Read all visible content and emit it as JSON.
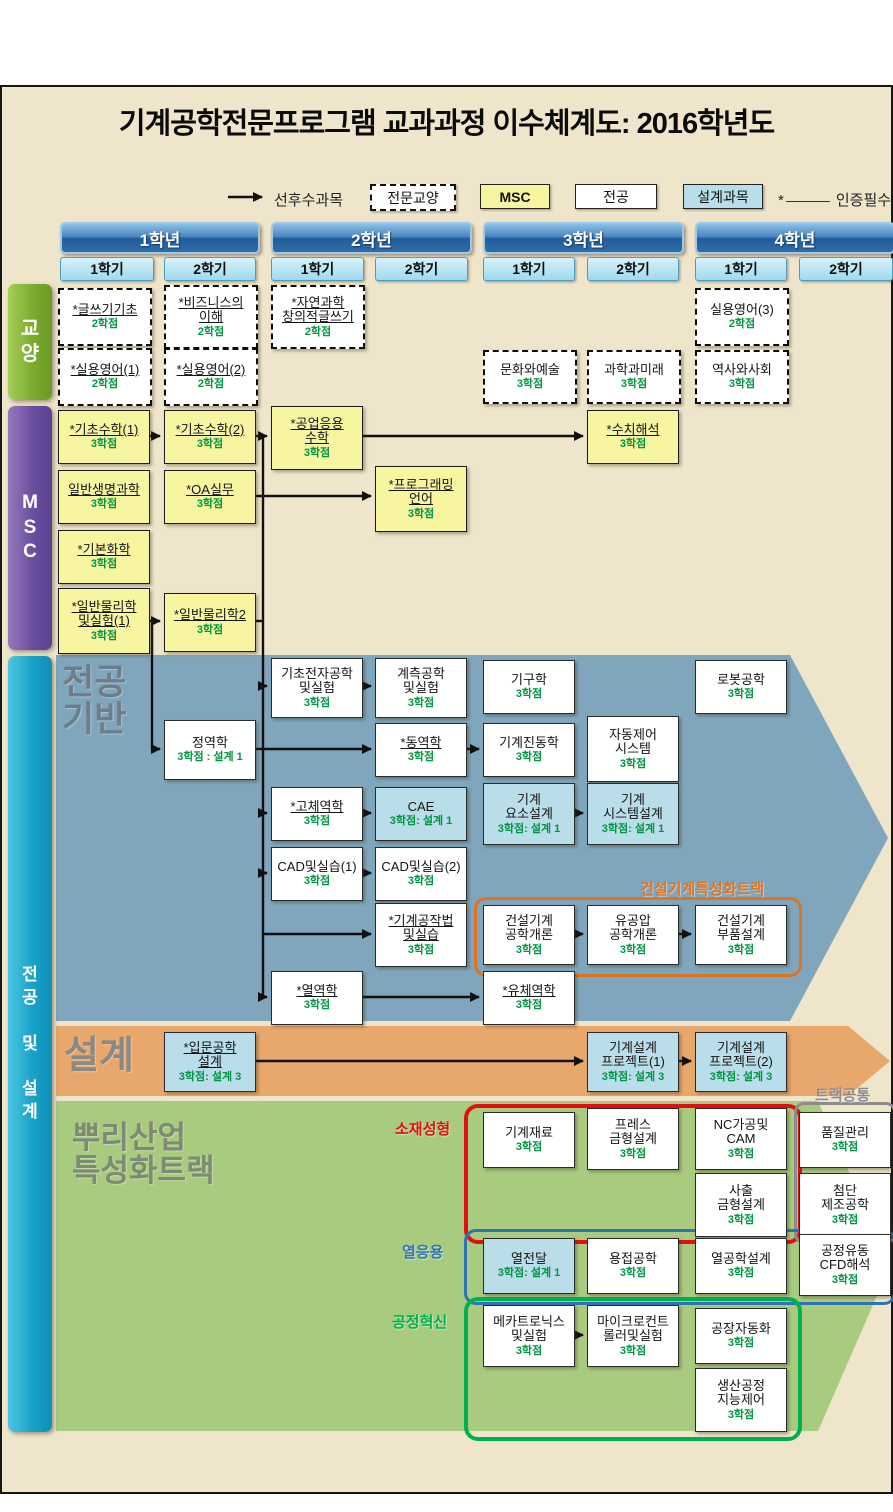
{
  "title": "기계공학전문프로그램 교과과정 이수체계도: 2016학년도",
  "legend": {
    "prereq_label": "선후수과목",
    "types": [
      {
        "label": "전문교양",
        "type": "ge"
      },
      {
        "label": "MSC",
        "type": "msc"
      },
      {
        "label": "전공",
        "type": "major"
      },
      {
        "label": "설계과목",
        "type": "design"
      }
    ],
    "cert_mark": "*",
    "cert_label": "인증필수"
  },
  "years": [
    {
      "label": "1학년",
      "semesters": [
        "1학기",
        "2학기"
      ]
    },
    {
      "label": "2학년",
      "semesters": [
        "1학기",
        "2학기"
      ]
    },
    {
      "label": "3학년",
      "semesters": [
        "1학기",
        "2학기"
      ]
    },
    {
      "label": "4학년",
      "semesters": [
        "1학기",
        "2학기"
      ]
    }
  ],
  "side_labels": {
    "ge": "교\n양",
    "msc": "M\nS\nC",
    "major": "전\n공\n\n및\n\n설\n계"
  },
  "section_labels": {
    "major_base": "전공\n기반",
    "design": "설계",
    "purli": "뿌리산업\n특성화트랙",
    "track_common": "트랙공통"
  },
  "track_labels": {
    "construction": "건설기계특성화트랙",
    "material": "소재성형",
    "thermal": "열응용",
    "process": "공정혁신"
  },
  "courses": [
    {
      "name": "*글쓰기기초",
      "credit": "2학점",
      "col": "1-1",
      "y": 288,
      "h": 54,
      "type": "ge",
      "u": true
    },
    {
      "name": "*비즈니스의\n이해",
      "credit": "2학점",
      "col": "1-2",
      "y": 285,
      "h": 60,
      "type": "ge",
      "u": true
    },
    {
      "name": "*자연과학\n창의적글쓰기",
      "credit": "2학점",
      "col": "2-1",
      "y": 285,
      "h": 60,
      "type": "ge",
      "u": true
    },
    {
      "name": "실용영어(3)",
      "credit": "2학점",
      "col": "4-1",
      "y": 288,
      "h": 54,
      "type": "ge",
      "u": false
    },
    {
      "name": "*실용영어(1)",
      "credit": "2학점",
      "col": "1-1",
      "y": 348,
      "h": 54,
      "type": "ge",
      "u": true
    },
    {
      "name": "*실용영어(2)",
      "credit": "2학점",
      "col": "1-2",
      "y": 348,
      "h": 54,
      "type": "ge",
      "u": true
    },
    {
      "name": "문화와예술",
      "credit": "3학점",
      "col": "3-1",
      "y": 350,
      "h": 50,
      "type": "ge",
      "u": false
    },
    {
      "name": "과학과미래",
      "credit": "3학점",
      "col": "3-2",
      "y": 350,
      "h": 50,
      "type": "ge",
      "u": false
    },
    {
      "name": "역사와사회",
      "credit": "3학점",
      "col": "4-1",
      "y": 350,
      "h": 50,
      "type": "ge",
      "u": false
    },
    {
      "name": "*기초수학(1)",
      "credit": "3학점",
      "col": "1-1",
      "y": 410,
      "h": 52,
      "type": "msc",
      "u": true
    },
    {
      "name": "*기초수학(2)",
      "credit": "3학점",
      "col": "1-2",
      "y": 410,
      "h": 52,
      "type": "msc",
      "u": true
    },
    {
      "name": "*공업응용\n수학",
      "credit": "3학점",
      "col": "2-1",
      "y": 406,
      "h": 62,
      "type": "msc",
      "u": true
    },
    {
      "name": "*수치해석",
      "credit": "3학점",
      "col": "3-2",
      "y": 410,
      "h": 52,
      "type": "msc",
      "u": true
    },
    {
      "name": "일반생명과학",
      "credit": "3학점",
      "col": "1-1",
      "y": 470,
      "h": 52,
      "type": "msc",
      "u": true
    },
    {
      "name": "*OA실무",
      "credit": "3학점",
      "col": "1-2",
      "y": 470,
      "h": 52,
      "type": "msc",
      "u": true
    },
    {
      "name": "*프로그래밍\n언어",
      "credit": "3학점",
      "col": "2-2",
      "y": 466,
      "h": 64,
      "type": "msc",
      "u": true
    },
    {
      "name": "*기본화학",
      "credit": "3학점",
      "col": "1-1",
      "y": 530,
      "h": 52,
      "type": "msc",
      "u": true
    },
    {
      "name": "*일반물리학\n및실험(1)",
      "credit": "3학점",
      "col": "1-1",
      "y": 588,
      "h": 64,
      "type": "msc",
      "u": true
    },
    {
      "name": "*일반물리학2",
      "credit": "3학점",
      "col": "1-2",
      "y": 593,
      "h": 57,
      "type": "msc",
      "u": true
    },
    {
      "name": "기초전자공학\n및실험",
      "credit": "3학점",
      "col": "2-1",
      "y": 658,
      "h": 58,
      "type": "major",
      "u": false
    },
    {
      "name": "계측공학\n및실험",
      "credit": "3학점",
      "col": "2-2",
      "y": 658,
      "h": 58,
      "type": "major",
      "u": false
    },
    {
      "name": "기구학",
      "credit": "3학점",
      "col": "3-1",
      "y": 660,
      "h": 52,
      "type": "major",
      "u": false
    },
    {
      "name": "로봇공학",
      "credit": "3학점",
      "col": "4-1",
      "y": 660,
      "h": 52,
      "type": "major",
      "u": false
    },
    {
      "name": "정역학",
      "credit": "3학점 : 설계 1",
      "col": "1-2",
      "y": 720,
      "h": 58,
      "type": "major",
      "u": false
    },
    {
      "name": "*동역학",
      "credit": "3학점",
      "col": "2-2",
      "y": 723,
      "h": 52,
      "type": "major",
      "u": true
    },
    {
      "name": "기계진동학",
      "credit": "3학점",
      "col": "3-1",
      "y": 723,
      "h": 52,
      "type": "major",
      "u": false
    },
    {
      "name": "자동제어\n시스템",
      "credit": "3학점",
      "col": "3-2",
      "y": 716,
      "h": 64,
      "type": "major",
      "u": false
    },
    {
      "name": "*고체역학",
      "credit": "3학점",
      "col": "2-1",
      "y": 787,
      "h": 52,
      "type": "major",
      "u": true
    },
    {
      "name": "CAE",
      "credit": "3학점: 설계 1",
      "col": "2-2",
      "y": 787,
      "h": 52,
      "type": "design",
      "u": false
    },
    {
      "name": "기계\n요소설계",
      "credit": "3학점: 설계 1",
      "col": "3-1",
      "y": 783,
      "h": 60,
      "type": "design",
      "u": false
    },
    {
      "name": "기계\n시스템설계",
      "credit": "3학점: 설계 1",
      "col": "3-2",
      "y": 783,
      "h": 60,
      "type": "design",
      "u": false
    },
    {
      "name": "CAD및실습(1)",
      "credit": "3학점",
      "col": "2-1",
      "y": 847,
      "h": 52,
      "type": "major",
      "u": false
    },
    {
      "name": "CAD및실습(2)",
      "credit": "3학점",
      "col": "2-2",
      "y": 847,
      "h": 52,
      "type": "major",
      "u": false
    },
    {
      "name": "*기계공작법\n및실습",
      "credit": "3학점",
      "col": "2-2",
      "y": 903,
      "h": 62,
      "type": "major",
      "u": true
    },
    {
      "name": "건설기계\n공학개론",
      "credit": "3학점",
      "col": "3-1",
      "y": 905,
      "h": 58,
      "type": "major",
      "u": false
    },
    {
      "name": "유공압\n공학개론",
      "credit": "3학점",
      "col": "3-2",
      "y": 905,
      "h": 58,
      "type": "major",
      "u": false
    },
    {
      "name": "건설기계\n부품설계",
      "credit": "3학점",
      "col": "4-1",
      "y": 905,
      "h": 58,
      "type": "major",
      "u": false
    },
    {
      "name": "*열역학",
      "credit": "3학점",
      "col": "2-1",
      "y": 971,
      "h": 52,
      "type": "major",
      "u": true
    },
    {
      "name": "*유체역학",
      "credit": "3학점",
      "col": "3-1",
      "y": 971,
      "h": 52,
      "type": "major",
      "u": true
    },
    {
      "name": "*입문공학\n설계",
      "credit": "3학점: 설계 3",
      "col": "1-2",
      "y": 1032,
      "h": 58,
      "type": "design",
      "u": true
    },
    {
      "name": "기계설계\n프로젝트(1)",
      "credit": "3학점: 설계 3",
      "col": "3-2",
      "y": 1032,
      "h": 58,
      "type": "design",
      "u": false
    },
    {
      "name": "기계설계\n프로젝트(2)",
      "credit": "3학점: 설계 3",
      "col": "4-1",
      "y": 1032,
      "h": 58,
      "type": "design",
      "u": false
    },
    {
      "name": "기계재료",
      "credit": "3학점",
      "col": "3-1",
      "y": 1112,
      "h": 54,
      "type": "major",
      "u": false
    },
    {
      "name": "프레스\n금형설계",
      "credit": "3학점",
      "col": "3-2",
      "y": 1108,
      "h": 60,
      "type": "major",
      "u": false
    },
    {
      "name": "NC가공및\nCAM",
      "credit": "3학점",
      "col": "4-1",
      "y": 1108,
      "h": 60,
      "type": "major",
      "u": false
    },
    {
      "name": "사출\n금형설계",
      "credit": "3학점",
      "col": "4-1",
      "y": 1173,
      "h": 62,
      "type": "major",
      "u": false
    },
    {
      "name": "품질관리",
      "credit": "3학점",
      "col": "4-2",
      "y": 1112,
      "h": 54,
      "type": "major",
      "u": false
    },
    {
      "name": "첨단\n제조공학",
      "credit": "3학점",
      "col": "4-2",
      "y": 1173,
      "h": 62,
      "type": "major",
      "u": false
    },
    {
      "name": "열전달",
      "credit": "3학점: 설계 1",
      "col": "3-1",
      "y": 1238,
      "h": 54,
      "type": "design",
      "u": false
    },
    {
      "name": "용접공학",
      "credit": "3학점",
      "col": "3-2",
      "y": 1238,
      "h": 54,
      "type": "major",
      "u": false
    },
    {
      "name": "열공학설계",
      "credit": "3학점",
      "col": "4-1",
      "y": 1238,
      "h": 54,
      "type": "major",
      "u": false
    },
    {
      "name": "공정유동\nCFD해석",
      "credit": "3학점",
      "col": "4-2",
      "y": 1234,
      "h": 60,
      "type": "major",
      "u": false
    },
    {
      "name": "메카트로닉스\n및실험",
      "credit": "3학점",
      "col": "3-1",
      "y": 1305,
      "h": 60,
      "type": "major",
      "u": false
    },
    {
      "name": "마이크로컨트\n롤러및실험",
      "credit": "3학점",
      "col": "3-2",
      "y": 1305,
      "h": 60,
      "type": "major",
      "u": false
    },
    {
      "name": "공장자동화",
      "credit": "3학점",
      "col": "4-1",
      "y": 1308,
      "h": 54,
      "type": "major",
      "u": false
    },
    {
      "name": "생산공정\n지능제어",
      "credit": "3학점",
      "col": "4-1",
      "y": 1368,
      "h": 62,
      "type": "major",
      "u": false
    }
  ],
  "colors": {
    "page_bg": "#EFE5CB",
    "msc_box": "#F7F5A0",
    "design_box": "#B9DDE9",
    "credit_text": "#009642",
    "major_section": "#7FA6BC",
    "design_section": "#E8A76B",
    "purli_section": "#A9CB7F",
    "construction_track": "#E0731F",
    "material_track": "#E01010",
    "thermal_track": "#2E74B5",
    "process_track": "#00B050",
    "common_track": "#8C8C8C"
  }
}
